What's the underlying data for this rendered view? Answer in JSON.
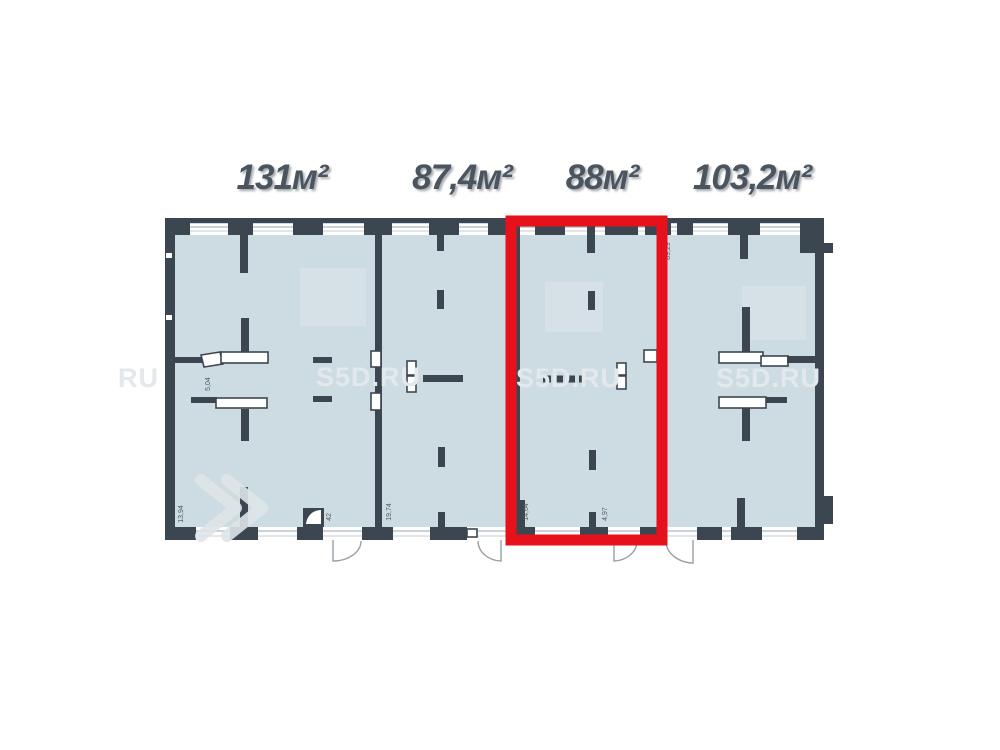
{
  "plan": {
    "title_watermark": "S5D.RU",
    "units": [
      {
        "id": "unit-131",
        "area_label": "131м²",
        "highlighted": false
      },
      {
        "id": "unit-87-4",
        "area_label": "87,4м²",
        "highlighted": false
      },
      {
        "id": "unit-88",
        "area_label": "88м²",
        "highlighted": true
      },
      {
        "id": "unit-103-2",
        "area_label": "103,2м²",
        "highlighted": false
      }
    ],
    "highlighted_unit_label": "88м²",
    "watermark_instances": [
      "RU",
      "S5D.RU",
      "S5D.RU",
      "S5D.RU"
    ],
    "dimension_labels": [
      "5,04",
      "13,94",
      "42",
      "19,74",
      "14,64",
      "4,97",
      "89,29"
    ],
    "colors": {
      "floor_fill": "#cddce2",
      "wall": "#3c4651",
      "window_line": "#adb8bf",
      "red_highlight": "#e6111b",
      "watermark": "#e2e8eb",
      "label_text": "#4a5560"
    }
  }
}
